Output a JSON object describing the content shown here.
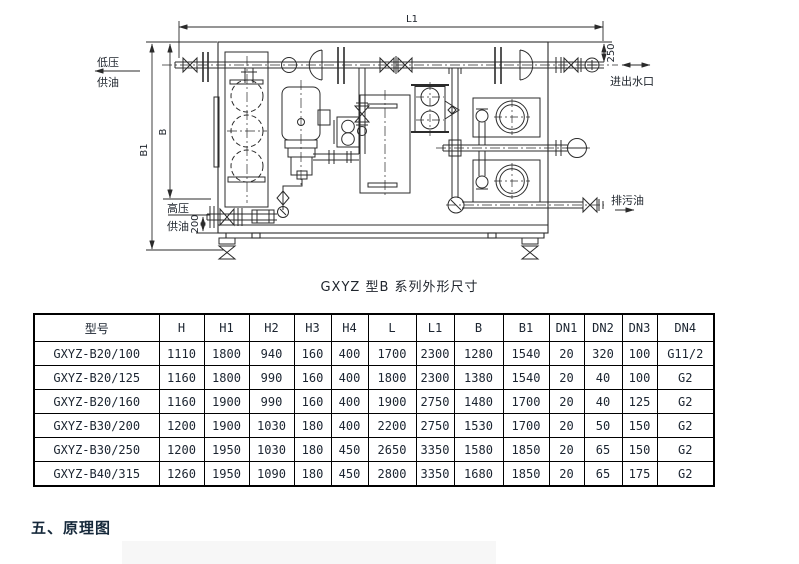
{
  "diagram": {
    "caption": "GXYZ 型B 系列外形尺寸",
    "labels": {
      "dim_l1": "L1",
      "dim_b1": "B1",
      "dim_b": "B",
      "dim_250": "250",
      "dim_200": "200",
      "low_pressure_line1": "低压",
      "low_pressure_line2": "供油",
      "high_pressure_line1": "高压",
      "high_pressure_line2": "供油",
      "water_port": "进出水口",
      "drain_oil": "排污油"
    }
  },
  "table": {
    "columns": [
      "型号",
      "H",
      "H1",
      "H2",
      "H3",
      "H4",
      "L",
      "L1",
      "B",
      "B1",
      "DN1",
      "DN2",
      "DN3",
      "DN4"
    ],
    "rows": [
      {
        "model": "GXYZ-B20/100",
        "values": [
          "1110",
          "1800",
          "940",
          "160",
          "400",
          "1700",
          "2300",
          "1280",
          "1540",
          "20",
          "320",
          "100",
          "G11/2"
        ]
      },
      {
        "model": "GXYZ-B20/125",
        "values": [
          "1160",
          "1800",
          "990",
          "160",
          "400",
          "1800",
          "2300",
          "1380",
          "1540",
          "20",
          "40",
          "100",
          "G2"
        ]
      },
      {
        "model": "GXYZ-B20/160",
        "values": [
          "1160",
          "1900",
          "990",
          "160",
          "400",
          "1900",
          "2750",
          "1480",
          "1700",
          "20",
          "40",
          "125",
          "G2"
        ]
      },
      {
        "model": "GXYZ-B30/200",
        "values": [
          "1200",
          "1900",
          "1030",
          "180",
          "400",
          "2200",
          "2750",
          "1530",
          "1700",
          "20",
          "50",
          "150",
          "G2"
        ]
      },
      {
        "model": "GXYZ-B30/250",
        "values": [
          "1200",
          "1950",
          "1030",
          "180",
          "450",
          "2650",
          "3350",
          "1580",
          "1850",
          "20",
          "65",
          "150",
          "G2"
        ]
      },
      {
        "model": "GXYZ-B40/315",
        "values": [
          "1260",
          "1950",
          "1090",
          "180",
          "450",
          "2800",
          "3350",
          "1680",
          "1850",
          "20",
          "65",
          "175",
          "G2"
        ]
      }
    ]
  },
  "section": {
    "heading": "五、原理图"
  },
  "colors": {
    "text": "#1b2430",
    "line": "#2b2b2b",
    "table_border": "#000000",
    "next_figure_bg": "#f7f7f7"
  }
}
